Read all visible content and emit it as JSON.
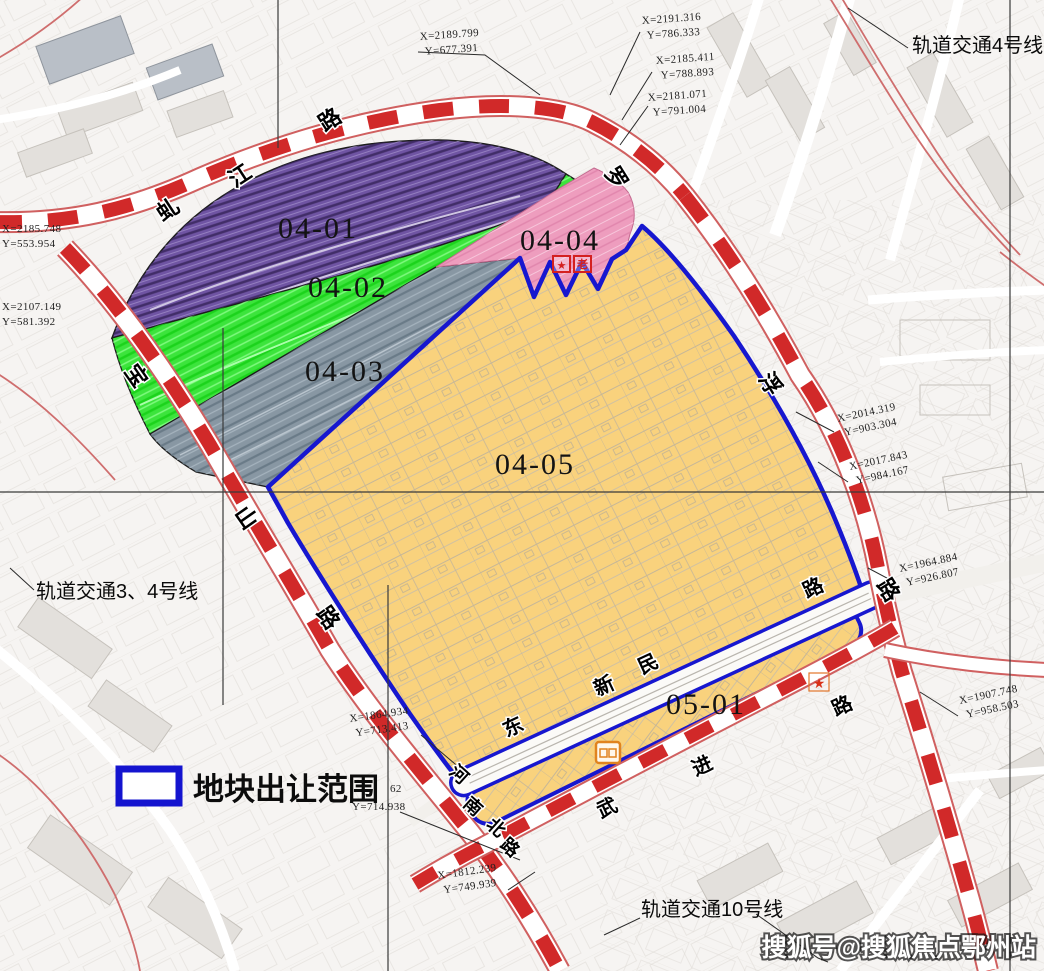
{
  "watermark": "搜狐号@搜狐焦点鄂州站",
  "legend": {
    "label": "地块出让范围"
  },
  "parcels": [
    {
      "id": "04-01"
    },
    {
      "id": "04-02"
    },
    {
      "id": "04-03"
    },
    {
      "id": "04-04"
    },
    {
      "id": "04-05"
    },
    {
      "id": "05-01"
    }
  ],
  "rail_lines": [
    {
      "label": "轨道交通4号线"
    },
    {
      "label": "轨道交通3、4号线"
    },
    {
      "label": "轨道交通10号线"
    }
  ],
  "roads": [
    {
      "name": "虬江路",
      "chars": [
        "虬",
        "江",
        "路"
      ]
    },
    {
      "name": "宝山路",
      "chars": [
        "宝",
        "山",
        "路"
      ]
    },
    {
      "name": "罗浮路",
      "chars": [
        "罗",
        "浮",
        "路"
      ]
    },
    {
      "name": "东新民路",
      "chars": [
        "东",
        "新",
        "民",
        "路"
      ]
    },
    {
      "name": "武进路",
      "chars": [
        "武",
        "进",
        "路"
      ]
    },
    {
      "name": "河南北路",
      "chars": [
        "河",
        "南",
        "北",
        "路"
      ]
    }
  ],
  "coordinates": [
    {
      "lines": [
        "X=2189.799",
        "Y=677.391"
      ]
    },
    {
      "lines": [
        "X=2191.316",
        "Y=786.333"
      ]
    },
    {
      "lines": [
        "X=2185.411",
        "Y=788.893"
      ]
    },
    {
      "lines": [
        "X=2181.071",
        "Y=791.004"
      ]
    },
    {
      "lines": [
        "X=2185.748",
        "Y=553.954"
      ]
    },
    {
      "lines": [
        "X=2107.149",
        "Y=581.392"
      ]
    },
    {
      "lines": [
        "X=2014.319",
        "Y=903.304"
      ]
    },
    {
      "lines": [
        "X=2017.843",
        "Y=984.167"
      ]
    },
    {
      "lines": [
        "X=1964.884",
        "Y=926.807"
      ]
    },
    {
      "lines": [
        "X=1907.748",
        "Y=958.503"
      ]
    },
    {
      "lines": [
        "X=1864.934",
        "Y=713.413"
      ]
    },
    {
      "lines": [
        "62",
        "Y=714.938"
      ]
    },
    {
      "lines": [
        "X=1812.239",
        "Y=749.939"
      ]
    }
  ],
  "markers": {
    "star": "★",
    "elder": "老",
    "parcel_star": "★"
  },
  "colors": {
    "boundary_blue": "#1717cf",
    "road_dash_red": "#cf1d1d",
    "parcel_yellow": "#f9d27d",
    "parcel_green": "#3ce43c",
    "parcel_pink": "#ee9dbe",
    "parcel_gray": "#8897a3",
    "parcel_purple": "#6f54a3"
  }
}
